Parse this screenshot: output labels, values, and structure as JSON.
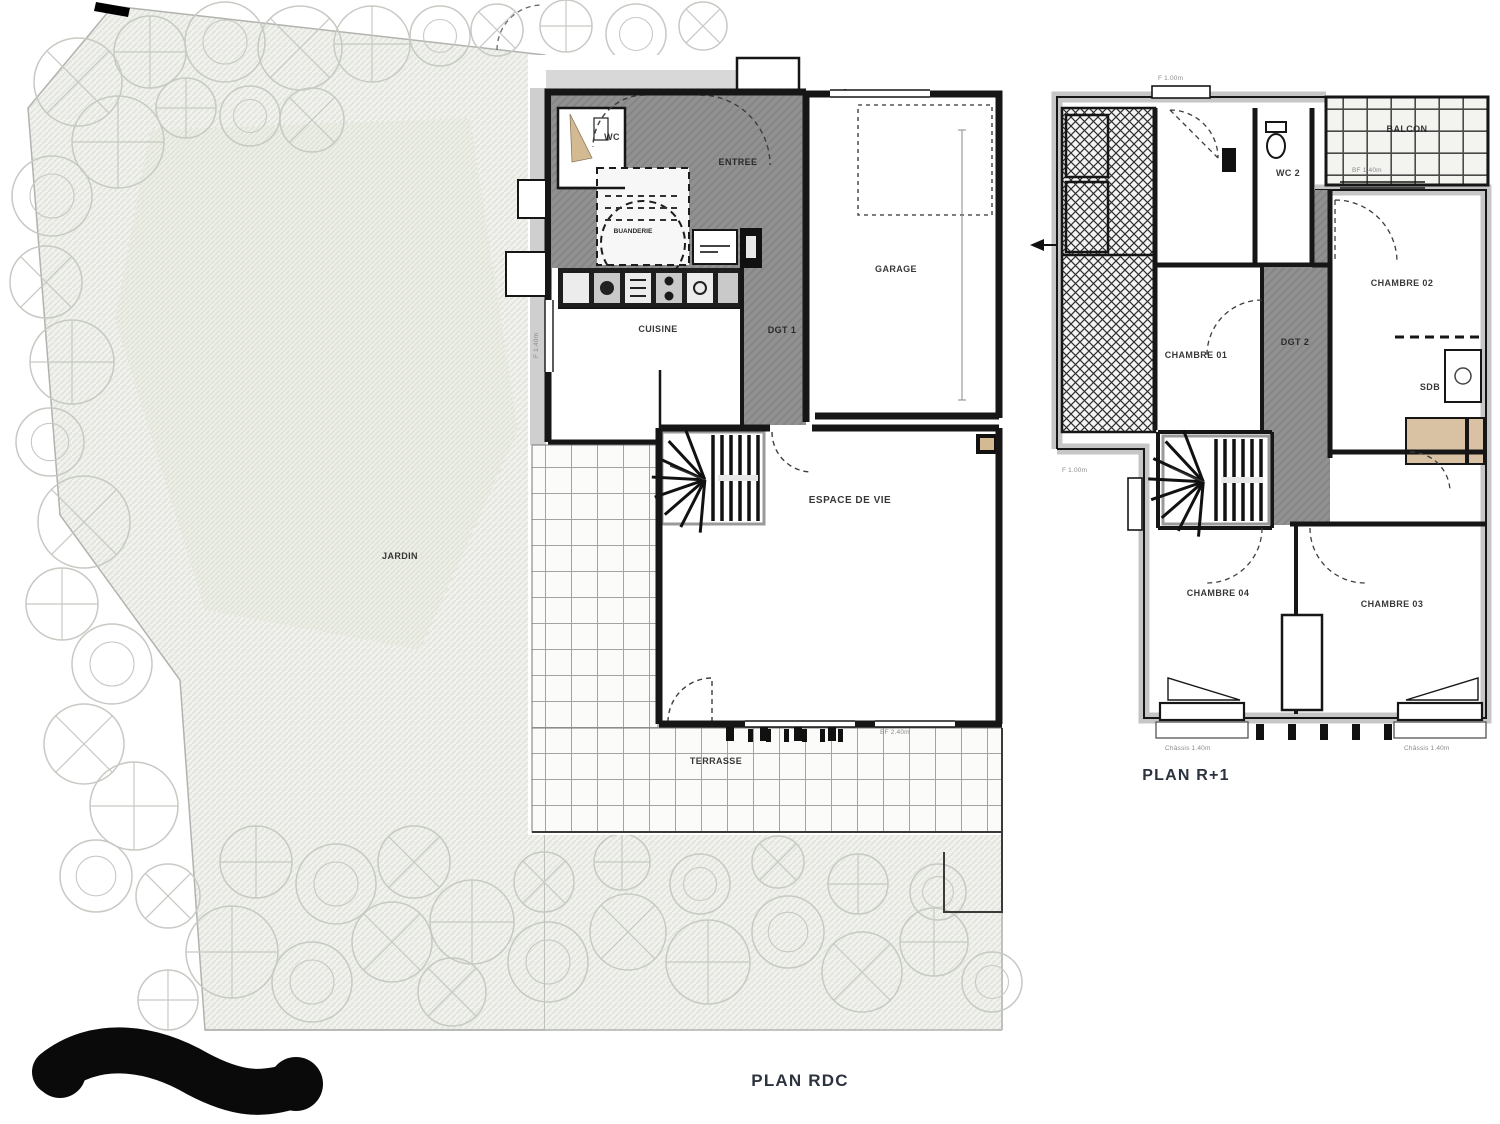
{
  "titles": {
    "rdc": "PLAN RDC",
    "r1": "PLAN R+1"
  },
  "rdc_rooms": {
    "wc": "WC",
    "entree": "ENTREE",
    "buanderie": "BUANDERIE",
    "cuisine": "CUISINE",
    "dgt1": "DGT 1",
    "garage": "GARAGE",
    "espace": "ESPACE DE VIE",
    "terrasse": "TERRASSE",
    "jardin": "JARDIN"
  },
  "r1_rooms": {
    "wc2": "WC 2",
    "balcon": "BALCON",
    "chambre01": "CHAMBRE 01",
    "chambre02": "CHAMBRE 02",
    "chambre03": "CHAMBRE 03",
    "chambre04": "CHAMBRE 04",
    "sdb": "SDB",
    "dgt2": "DGT 2"
  },
  "annotations": {
    "window_f140": "F 1.40m",
    "bay_bf240": "BF 2.40m",
    "r1_window_f100": "F 1.00m",
    "r1_stair_window": "F 1.00m",
    "chassis_left": "Châssis 1.40m",
    "chassis_right": "Châssis 1.40m",
    "balcon_bf": "BF 1.40m"
  },
  "colors": {
    "wall": "#161616",
    "floor_gray": "#8f8f8f",
    "tile_line": "#9b9b9b",
    "lawn": "#f1f2ed",
    "tree_stroke": "#c6cac3",
    "accent_tan": "#d4ba92",
    "title_text": "#2c333e"
  }
}
